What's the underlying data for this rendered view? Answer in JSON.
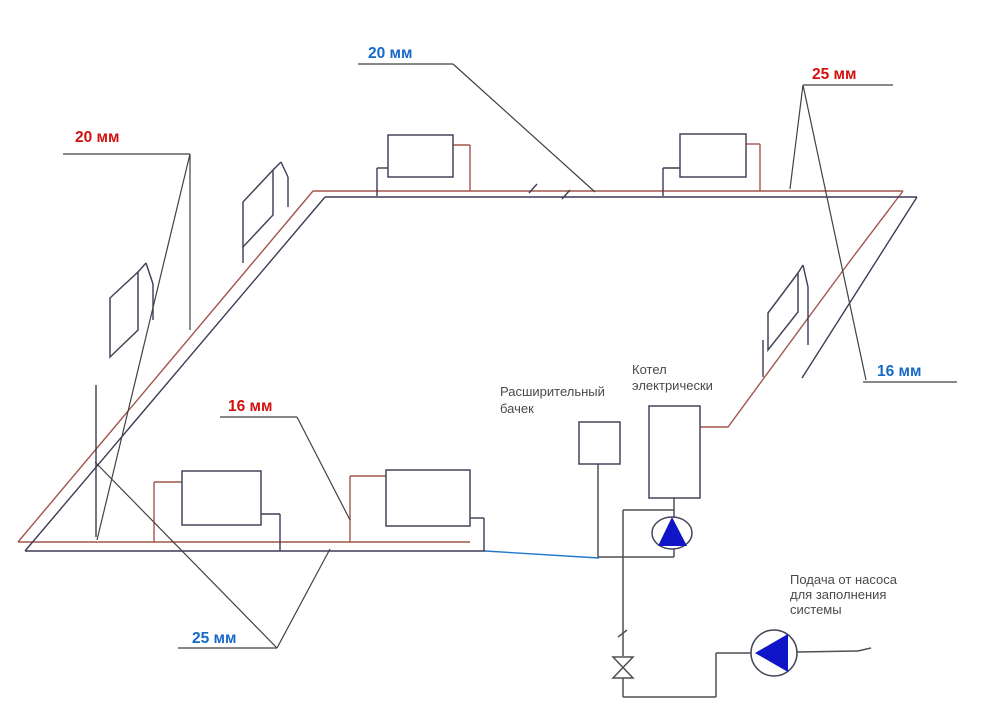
{
  "diagram": {
    "type": "heating-system-piping-scheme",
    "language": "ru"
  },
  "colors": {
    "background": "#ffffff",
    "pipe_supply_red": "#a2564c",
    "pipe_dark": "#3c3c56",
    "pipe_return_blue": "#2277cc",
    "leader_gray": "#424242",
    "outline_dark": "#45455a",
    "plumbing_gray": "#4f4f55",
    "pump_blue": "#1016c8",
    "label_red": "#d40f0f",
    "label_blue": "#1668c9",
    "label_gray": "#4a4a4a"
  },
  "labels": {
    "dim_top_left": "20 мм",
    "dim_top_center": "20 мм",
    "dim_top_right": "25 мм",
    "dim_right": "16 мм",
    "dim_middle_left": "16 мм",
    "dim_bottom": "25 мм",
    "expansion_tank_line1": "Расширительный",
    "expansion_tank_line2": "бачек",
    "boiler_line1": "Котел",
    "boiler_line2": "электрически",
    "pump_note_line1": "Подача от насоса",
    "pump_note_line2": "для заполнения",
    "pump_note_line3": "системы"
  }
}
